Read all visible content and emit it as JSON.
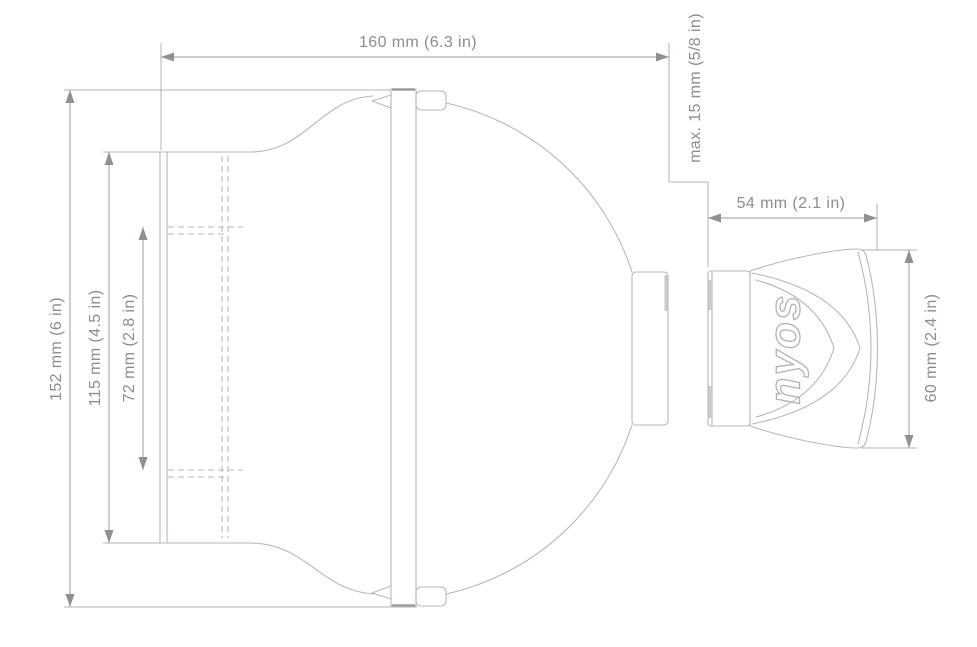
{
  "diagram": {
    "dimensions": {
      "total_width": "160 mm (6.3 in)",
      "total_height": "152 mm (6 in)",
      "body_height": "115 mm (4.5 in)",
      "inner_height": "72 mm (2.8 in)",
      "mount_gap": "max. 15 mm (5/8 in)",
      "remote_width": "54 mm (2.1 in)",
      "remote_height": "60 mm (2.4 in)"
    },
    "brand_logo": "nyos",
    "colors": {
      "background": "#ffffff",
      "outline": "#b6b9bb",
      "dimension_line": "#9b9ea1",
      "dimension_text": "#8b8e91",
      "arrow": "#8e9194"
    }
  }
}
